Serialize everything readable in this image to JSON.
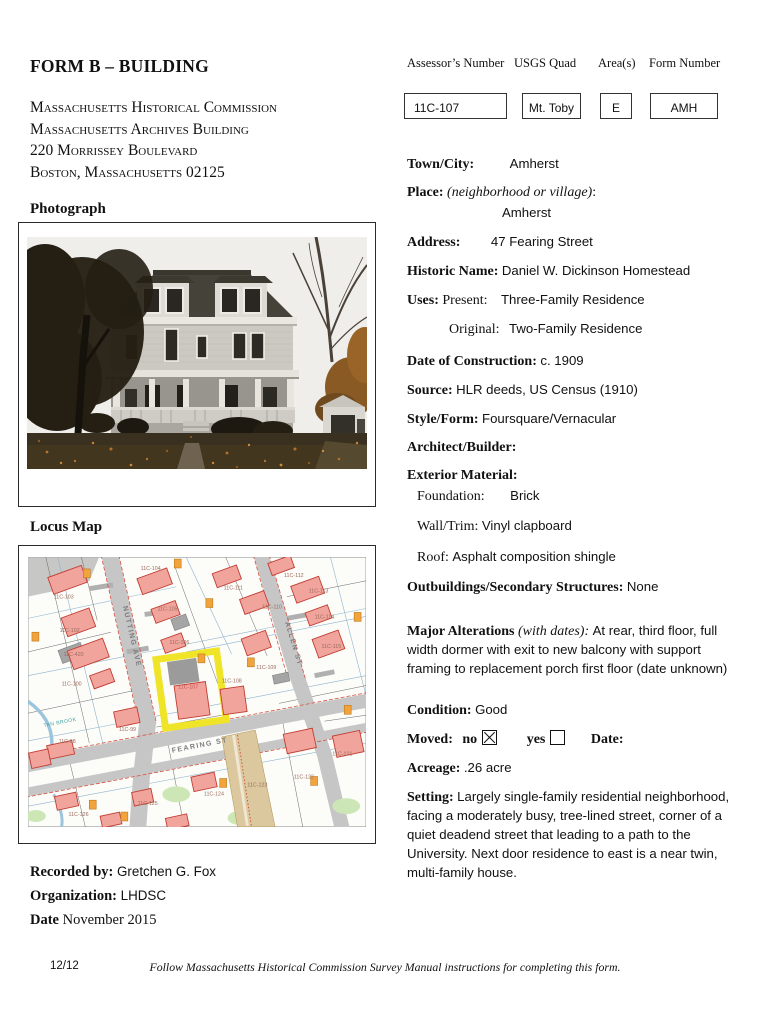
{
  "page": {
    "title": "FORM B – BUILDING",
    "agency_line1": "Massachusetts Historical Commission",
    "agency_line2": "Massachusetts Archives Building",
    "agency_line3": "220 Morrissey Boulevard",
    "agency_line4": "Boston, Massachusetts 02125",
    "footer_page": "12/12",
    "footer_note": "Follow Massachusetts Historical Commission Survey Manual instructions for completing this form."
  },
  "sections": {
    "photograph_heading": "Photograph",
    "locus_map_heading": "Locus Map"
  },
  "header_boxes": {
    "assessors_label": "Assessor’s Number",
    "assessors_value": "11C-107",
    "usgs_label": "USGS Quad",
    "usgs_value": "Mt. Toby",
    "area_label": "Area(s)",
    "area_value": "E",
    "form_label": "Form Number",
    "form_value": "AMH"
  },
  "fields": {
    "town_label": "Town/City:",
    "town_value": "Amherst",
    "place_label": "Place:",
    "place_hint": "(neighborhood or village)",
    "place_colon": ":",
    "place_value": "Amherst",
    "address_label": "Address:",
    "address_value": "47 Fearing Street",
    "historic_label": "Historic Name:",
    "historic_value": "Daniel W. Dickinson Homestead",
    "uses_label": "Uses:",
    "present_label": "Present:",
    "present_value": "Three-Family Residence",
    "original_label": "Original:",
    "original_value": "Two-Family Residence",
    "construction_label": "Date of Construction:",
    "construction_value": "c. 1909",
    "source_label": "Source:",
    "source_value": "HLR deeds, US Census (1910)",
    "style_label": "Style/Form:",
    "style_value": "Foursquare/Vernacular",
    "architect_label": "Architect/Builder:",
    "exterior_label": "Exterior Material:",
    "foundation_label": "Foundation:",
    "foundation_value": "Brick",
    "wall_label": "Wall/Trim:",
    "wall_value": "Vinyl clapboard",
    "roof_label": "Roof:",
    "roof_value": "Asphalt composition shingle",
    "outbuildings_label": "Outbuildings/Secondary Structures:",
    "outbuildings_value": "None",
    "alterations_label": "Major Alterations",
    "alterations_hint": "(with dates):",
    "alterations_value": "At rear, third floor, full width dormer with exit to new balcony with support framing to replacement porch first floor (date unknown)",
    "condition_label": "Condition:",
    "condition_value": "Good",
    "moved_label": "Moved:",
    "moved_no_label": "no",
    "moved_no_checked": true,
    "moved_yes_label": "yes",
    "moved_yes_checked": false,
    "moved_date_label": "Date:",
    "acreage_label": "Acreage:",
    "acreage_value": ".26 acre",
    "setting_label": "Setting:",
    "setting_value": "Largely single-family residential neighborhood, facing a moderately busy, tree-lined street, corner of a quiet deadend street that leading to a path to the University. Next door residence to east is a near twin, multi-family house."
  },
  "recorded": {
    "recorded_label": "Recorded by:",
    "recorded_value": "Gretchen G. Fox",
    "organization_label": "Organization:",
    "organization_value": "LHDSC",
    "date_label": "Date",
    "date_value": "November 2015"
  },
  "locus_map": {
    "streets": {
      "nutting": "NUTTING AVE",
      "allen": "ALLEN ST",
      "fearing": "FEARING ST"
    },
    "brook_label": "TAN BROOK",
    "highlighted_parcel": "11C-107",
    "highlight_color": "#f0e428",
    "building_color": "#f0a49c",
    "road_color": "#c6c6c6",
    "parcels": [
      "11C-103",
      "11C-104",
      "11C-102",
      "11C-105",
      "11C-106",
      "11C-420",
      "11C-100",
      "11C-98",
      "11C-99",
      "11C-107",
      "11C-108",
      "11C-109",
      "11C-110",
      "11C-111",
      "11C-112",
      "11C-113",
      "11C-114",
      "11C-115",
      "11C-121",
      "11C-122",
      "11C-123",
      "11C-124",
      "11C-125",
      "11C-126"
    ]
  }
}
